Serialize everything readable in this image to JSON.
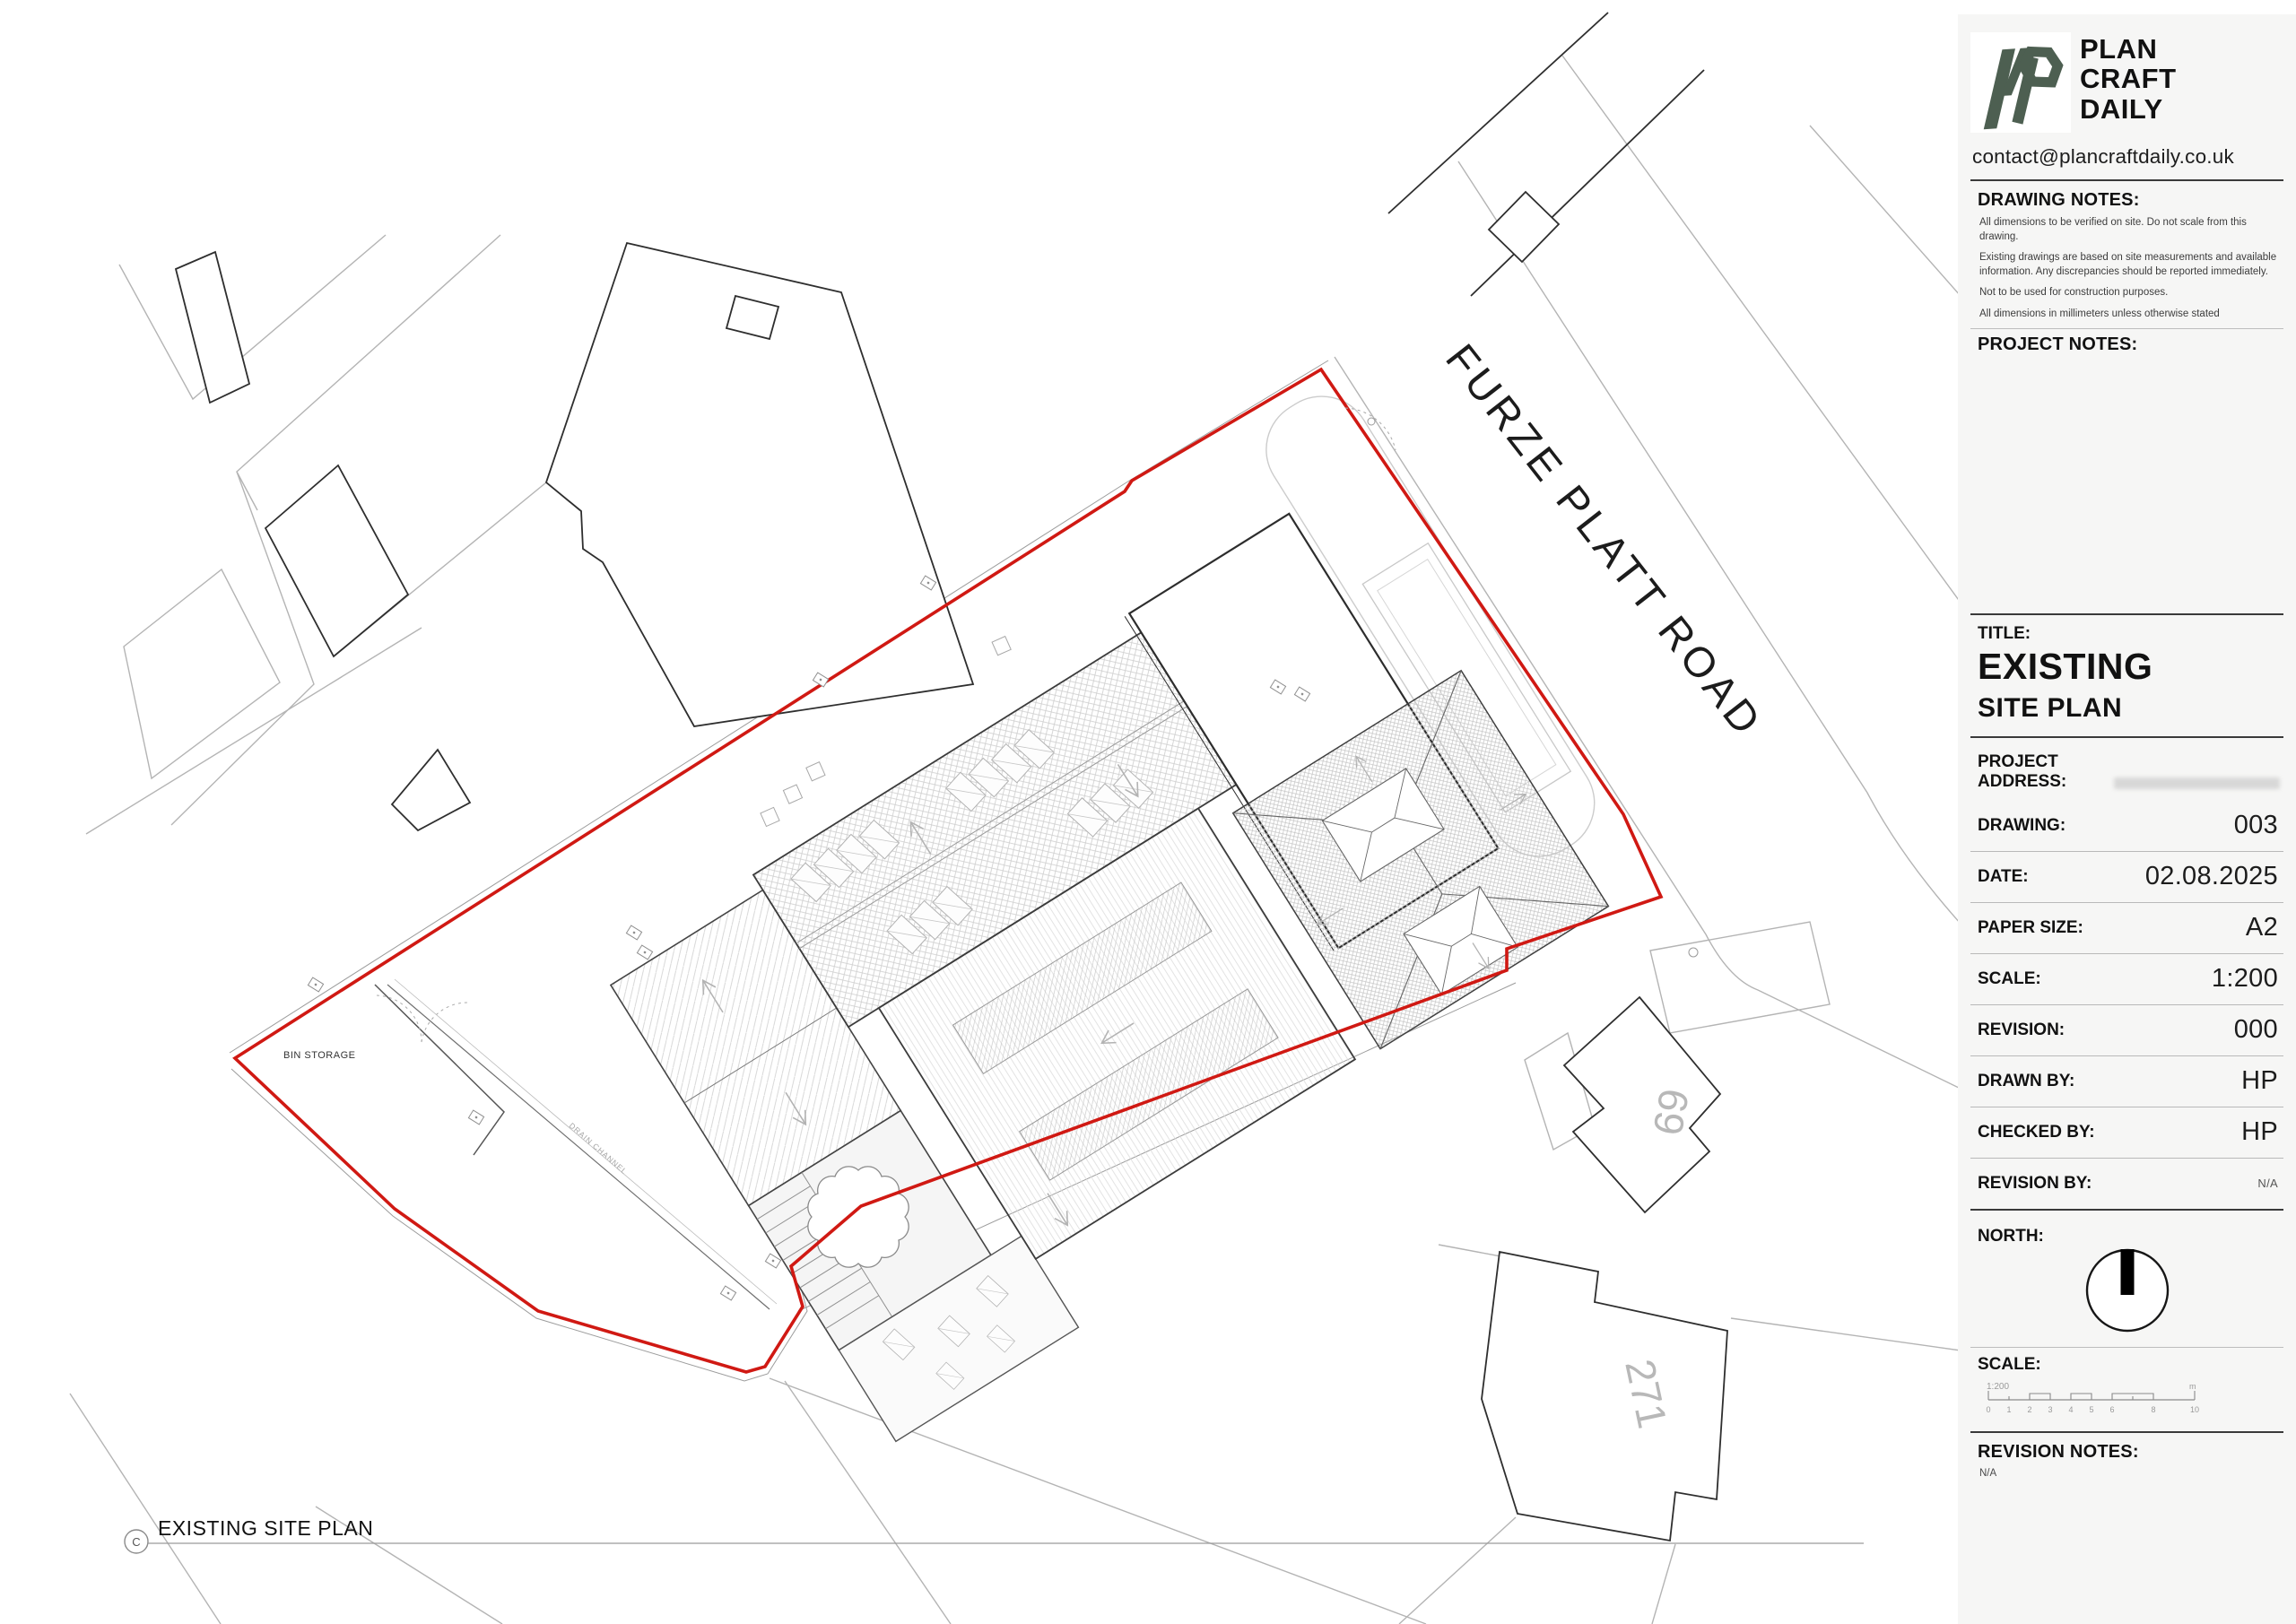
{
  "company": {
    "name_lines": [
      "PLAN",
      "CRAFT",
      "DAILY"
    ],
    "email": "contact@plancraftdaily.co.uk",
    "logo_color": "#4d5f51"
  },
  "drawing_notes": {
    "heading": "DRAWING NOTES:",
    "notes": [
      "All dimensions to be verified on site. Do not scale from this drawing.",
      "Existing drawings are based on site measurements and available information. Any discrepancies should be reported immediately.",
      "Not to be used for construction purposes.",
      "All dimensions in millimeters unless otherwise stated"
    ]
  },
  "project_notes": {
    "heading": "PROJECT NOTES:"
  },
  "title_block": {
    "label": "TITLE:",
    "line1": "EXISTING",
    "line2": "SITE PLAN"
  },
  "address": {
    "label": "PROJECT ADDRESS:",
    "value_redacted": true
  },
  "fields": [
    {
      "label": "DRAWING:",
      "value": "003"
    },
    {
      "label": "DATE:",
      "value": "02.08.2025"
    },
    {
      "label": "PAPER SIZE:",
      "value": "A2"
    },
    {
      "label": "SCALE:",
      "value": "1:200"
    },
    {
      "label": "REVISION:",
      "value": "000"
    },
    {
      "label": "DRAWN BY:",
      "value": "HP"
    },
    {
      "label": "CHECKED BY:",
      "value": "HP"
    },
    {
      "label": "REVISION BY:",
      "value": "N/A"
    }
  ],
  "north": {
    "label": "NORTH:"
  },
  "scalebar": {
    "label": "SCALE:",
    "ratio": "1:200",
    "ticks": [
      "0",
      "1",
      "2",
      "3",
      "4",
      "5",
      "6",
      "8",
      "10"
    ],
    "unit": "m"
  },
  "revision_notes": {
    "heading": "REVISION NOTES:",
    "value": "N/A"
  },
  "plan": {
    "road_label": "FURZE PLATT ROAD",
    "bin_storage_label": "BIN STORAGE",
    "drain_label": "DRAIN CHANNEL",
    "house_69": "69",
    "house_271": "271",
    "caption_symbol": "C",
    "caption": "EXISTING SITE PLAN",
    "boundary_color": "#d01913"
  }
}
